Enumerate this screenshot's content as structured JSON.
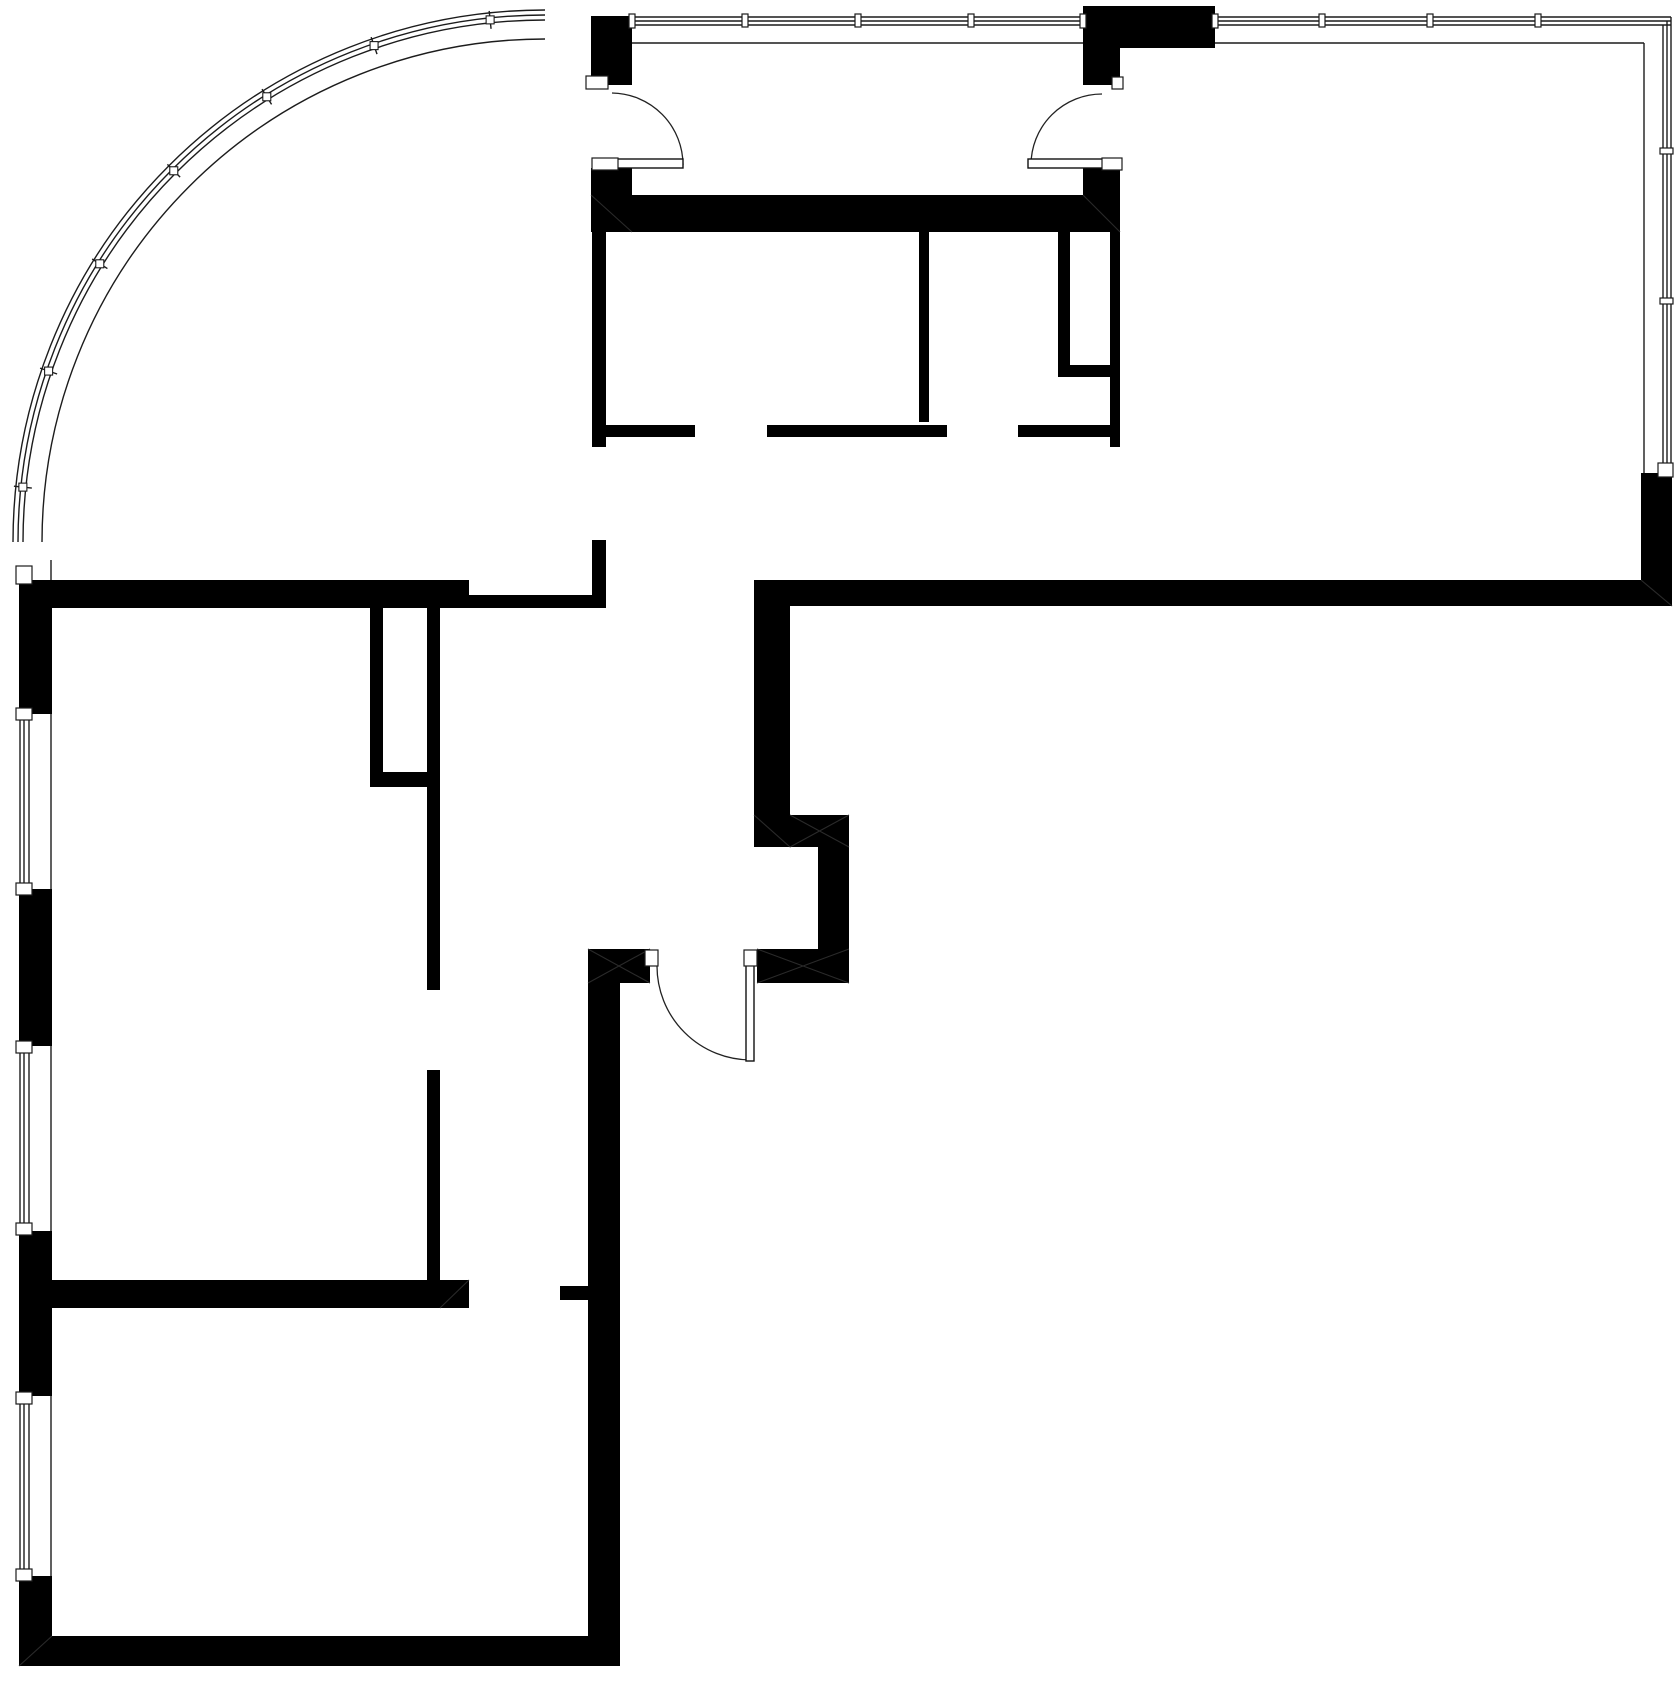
{
  "plan": {
    "canvas_w": 1680,
    "canvas_h": 1692,
    "bg_color": "#ffffff",
    "wall_color": "#000000",
    "thin_line_color": "#1c1c1c",
    "walls": [
      [
        591,
        16,
        41,
        69
      ],
      [
        1083,
        6,
        132,
        42
      ],
      [
        1083,
        48,
        37,
        37
      ],
      [
        591,
        168,
        41,
        27
      ],
      [
        591,
        195,
        529,
        37
      ],
      [
        1083,
        168,
        37,
        27
      ],
      [
        592,
        232,
        14,
        215
      ],
      [
        592,
        540,
        14,
        68
      ],
      [
        1058,
        232,
        12,
        133
      ],
      [
        1058,
        365,
        62,
        12
      ],
      [
        1110,
        232,
        10,
        215
      ],
      [
        919,
        232,
        10,
        190
      ],
      [
        606,
        425,
        89,
        12
      ],
      [
        767,
        425,
        180,
        12
      ],
      [
        1018,
        425,
        92,
        12
      ],
      [
        19,
        580,
        450,
        28
      ],
      [
        469,
        595,
        137,
        13
      ],
      [
        754,
        580,
        918,
        26
      ],
      [
        754,
        580,
        36,
        235
      ],
      [
        754,
        815,
        95,
        32
      ],
      [
        818,
        847,
        31,
        102
      ],
      [
        757,
        949,
        92,
        34
      ],
      [
        588,
        949,
        62,
        34
      ],
      [
        588,
        983,
        32,
        683
      ],
      [
        560,
        1286,
        28,
        14
      ],
      [
        370,
        608,
        13,
        179
      ],
      [
        370,
        772,
        70,
        15
      ],
      [
        427,
        608,
        13,
        382
      ],
      [
        427,
        1070,
        13,
        212
      ],
      [
        19,
        1280,
        450,
        28
      ],
      [
        19,
        1636,
        601,
        30
      ],
      [
        19,
        586,
        33,
        128
      ],
      [
        19,
        889,
        33,
        157
      ],
      [
        19,
        1231,
        33,
        165
      ],
      [
        19,
        1576,
        33,
        60
      ],
      [
        1641,
        473,
        31,
        133
      ]
    ],
    "diagonals": [
      [
        591,
        195,
        632,
        232
      ],
      [
        1083,
        195,
        1120,
        232
      ],
      [
        754,
        815,
        790,
        847
      ],
      [
        790,
        815,
        849,
        847
      ],
      [
        790,
        847,
        849,
        815
      ],
      [
        588,
        949,
        650,
        983
      ],
      [
        588,
        983,
        650,
        949
      ],
      [
        757,
        949,
        849,
        983
      ],
      [
        757,
        983,
        849,
        949
      ],
      [
        1641,
        580,
        1672,
        606
      ],
      [
        19,
        1666,
        52,
        1636
      ],
      [
        440,
        1308,
        469,
        1280
      ]
    ],
    "thin_lines": [
      [
        20,
        714,
        20,
        889
      ],
      [
        24,
        714,
        24,
        889
      ],
      [
        29,
        714,
        29,
        889
      ],
      [
        20,
        1047,
        20,
        1229
      ],
      [
        24,
        1047,
        24,
        1229
      ],
      [
        29,
        1047,
        29,
        1229
      ],
      [
        20,
        1398,
        20,
        1575
      ],
      [
        24,
        1398,
        24,
        1575
      ],
      [
        29,
        1398,
        29,
        1575
      ],
      [
        51,
        560,
        51,
        1636
      ],
      [
        632,
        17,
        1083,
        17
      ],
      [
        632,
        21,
        1083,
        21
      ],
      [
        632,
        25,
        1083,
        25
      ],
      [
        1215,
        17,
        1671,
        17
      ],
      [
        1215,
        21,
        1671,
        21
      ],
      [
        1215,
        25,
        1671,
        25
      ],
      [
        632,
        43,
        1644,
        43
      ],
      [
        1663,
        25,
        1663,
        470
      ],
      [
        1667,
        21,
        1667,
        470
      ],
      [
        1671,
        17,
        1671,
        470
      ],
      [
        1644,
        43,
        1644,
        473
      ]
    ],
    "curtain_arcs": [
      "M 13 542 A 532 532 0 0 1 545 10",
      "M 18 542 A 527 527 0 0 1 545 15",
      "M 23 542 A 522 522 0 0 1 545 20",
      "M 42 542 A 503 503 0 0 1 545 39"
    ],
    "curtain_ticks": {
      "cx": 545,
      "cy": 542,
      "r1": 516,
      "r2": 534,
      "cap_r": 525,
      "cap_size": 8,
      "angles": [
        186,
        199,
        212,
        225,
        238,
        251,
        264
      ]
    },
    "door_arcs": [
      "M 683 165 A 72 72 0 0 0 612 93",
      "M 1031 165 A 71 71 0 0 1 1102 94",
      "M 751 1060 A 94 94 0 0 1 657 966"
    ],
    "door_leaves": [
      [
        607,
        159,
        76,
        9
      ],
      [
        1028,
        159,
        75,
        9
      ],
      [
        746,
        963,
        8,
        98
      ]
    ],
    "caps": [
      [
        586,
        76,
        22,
        13
      ],
      [
        592,
        158,
        26,
        12
      ],
      [
        1102,
        158,
        20,
        12
      ],
      [
        1112,
        77,
        11,
        12
      ],
      [
        645,
        950,
        13,
        16
      ],
      [
        744,
        950,
        13,
        16
      ],
      [
        16,
        566,
        16,
        18
      ],
      [
        16,
        708,
        16,
        12
      ],
      [
        16,
        883,
        16,
        12
      ],
      [
        16,
        1041,
        16,
        12
      ],
      [
        16,
        1223,
        16,
        12
      ],
      [
        16,
        1392,
        16,
        12
      ],
      [
        16,
        1569,
        16,
        12
      ],
      [
        742,
        14,
        6,
        13
      ],
      [
        855,
        14,
        6,
        13
      ],
      [
        968,
        14,
        6,
        13
      ],
      [
        1319,
        14,
        6,
        13
      ],
      [
        1427,
        14,
        6,
        13
      ],
      [
        1535,
        14,
        6,
        13
      ],
      [
        629,
        14,
        6,
        14
      ],
      [
        1080,
        14,
        6,
        14
      ],
      [
        1212,
        14,
        6,
        14
      ],
      [
        1660,
        148,
        13,
        6
      ],
      [
        1660,
        298,
        13,
        6
      ],
      [
        1658,
        463,
        15,
        14
      ]
    ]
  }
}
